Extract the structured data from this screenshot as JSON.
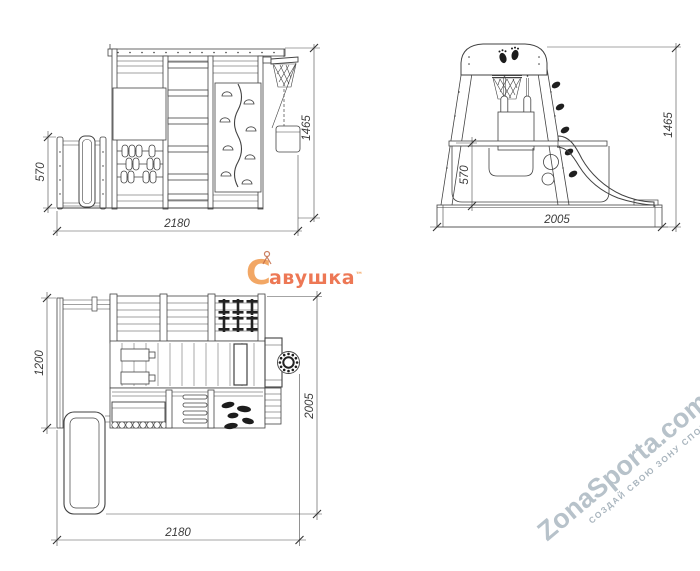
{
  "views": {
    "front": {
      "dim_height_small": "570",
      "dim_width": "2180",
      "dim_height_total": "1465"
    },
    "side": {
      "dim_platform_height": "570",
      "dim_depth": "2005",
      "dim_height_total": "1465"
    },
    "plan": {
      "dim_side_section": "1200",
      "dim_width": "2180",
      "dim_depth": "2005"
    }
  },
  "brand": {
    "initial": "С",
    "name_rest": "авушка",
    "trademark": "™"
  },
  "watermark": {
    "title": "ZonaSporta.com",
    "tagline": "СОЗДАЙ СВОЮ ЗОНУ СПОРТА"
  },
  "colors": {
    "line": "#3f3f3f",
    "dim_text": "#3a3a3a",
    "brand_orange": "#f0923f",
    "brand_red": "#e9572b",
    "watermark": "#b7c2ca"
  }
}
